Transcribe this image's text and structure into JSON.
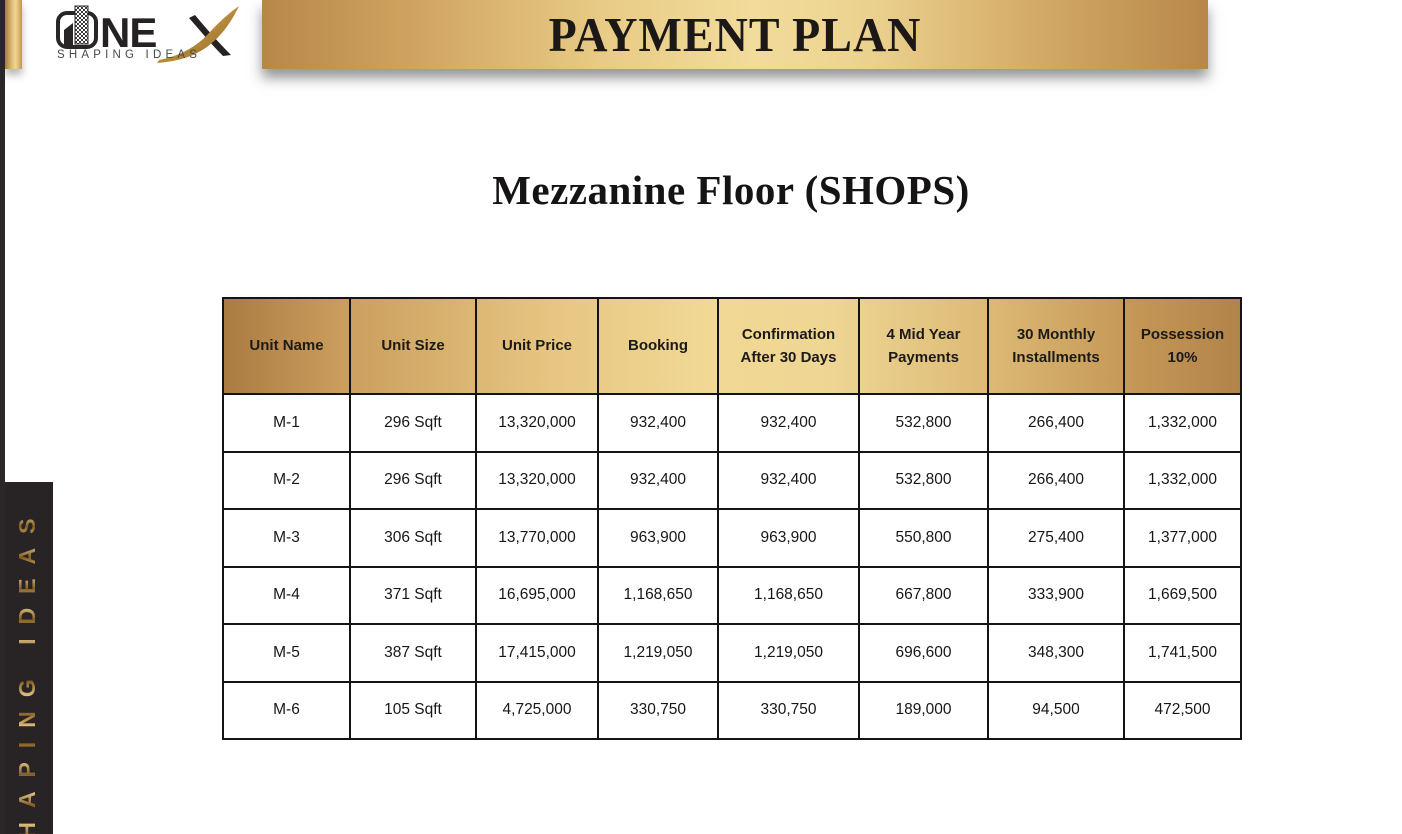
{
  "banner": {
    "title": "PAYMENT PLAN"
  },
  "logo": {
    "brand": "NE",
    "tagline": "SHAPING IDEAS"
  },
  "heading": {
    "title": "Mezzanine Floor (SHOPS)"
  },
  "sidebar": {
    "vertical_text": "SHAPING IDEAS"
  },
  "table": {
    "columns": [
      "Unit Name",
      "Unit Size",
      "Unit Price",
      "Booking",
      "Confirmation After 30 Days",
      "4 Mid Year Payments",
      "30 Monthly Installments",
      "Possession 10%"
    ],
    "rows": [
      [
        "M-1",
        "296 Sqft",
        "13,320,000",
        "932,400",
        "932,400",
        "532,800",
        "266,400",
        "1,332,000"
      ],
      [
        "M-2",
        "296 Sqft",
        "13,320,000",
        "932,400",
        "932,400",
        "532,800",
        "266,400",
        "1,332,000"
      ],
      [
        "M-3",
        "306 Sqft",
        "13,770,000",
        "963,900",
        "963,900",
        "550,800",
        "275,400",
        "1,377,000"
      ],
      [
        "M-4",
        "371 Sqft",
        "16,695,000",
        "1,168,650",
        "1,168,650",
        "667,800",
        "333,900",
        "1,669,500"
      ],
      [
        "M-5",
        "387 Sqft",
        "17,415,000",
        "1,219,050",
        "1,219,050",
        "696,600",
        "348,300",
        "1,741,500"
      ],
      [
        "M-6",
        "105 Sqft",
        "4,725,000",
        "330,750",
        "330,750",
        "189,000",
        "94,500",
        "472,500"
      ]
    ]
  },
  "colors": {
    "gold_dark": "#aa7b41",
    "gold_light": "#f1d995",
    "panel_dark": "#282324",
    "text_dark": "#1a1a1a"
  }
}
